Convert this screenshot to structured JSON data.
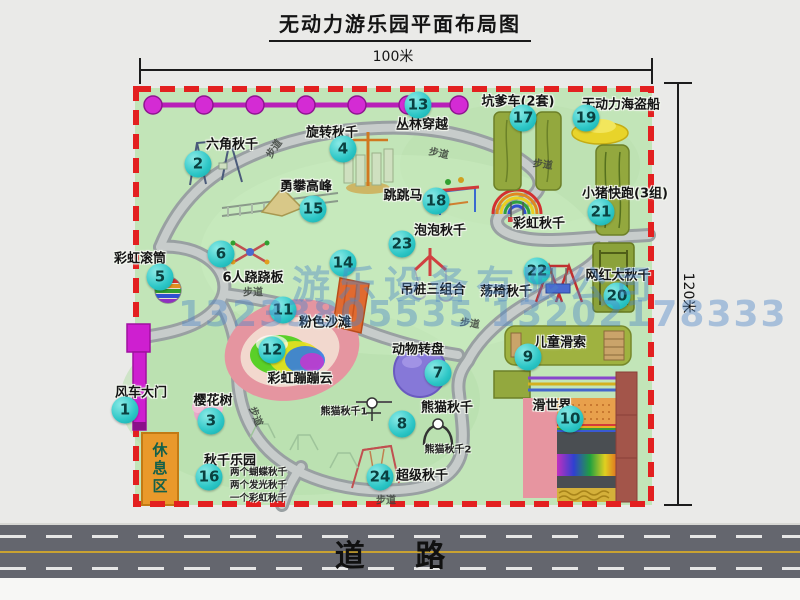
{
  "title": "无动力游乐园平面布局图",
  "dim_top": "100米",
  "dim_right": "120米",
  "road_label": "道  路",
  "rest_area": "休息区",
  "watermark": {
    "company": "游乐设备有限公司",
    "phone": "13233805535 13202178333"
  },
  "colors": {
    "park_green": "#c2e5b8",
    "border_red": "#e32020",
    "badge_cyan": "#2cc6c6",
    "gate_magenta": "#ce1fd0",
    "rest_orange": "#e9992b",
    "road_gray": "#64666e",
    "chain_pink": "#d42bd4",
    "equipment_olive": "#93a83e"
  },
  "features": [
    {
      "num": "1",
      "label": "风车大门",
      "lx": 141,
      "ly": 391,
      "bx": 125,
      "by": 410
    },
    {
      "num": "2",
      "label": "六角秋千",
      "lx": 232,
      "ly": 143,
      "bx": 198,
      "by": 164
    },
    {
      "num": "3",
      "label": "樱花树",
      "lx": 213,
      "ly": 399,
      "bx": 211,
      "by": 421
    },
    {
      "num": "4",
      "label": "旋转秋千",
      "lx": 332,
      "ly": 131,
      "bx": 343,
      "by": 149
    },
    {
      "num": "5",
      "label": "彩虹滚筒",
      "lx": 140,
      "ly": 257,
      "bx": 160,
      "by": 277
    },
    {
      "num": "6",
      "label": "6人跷跷板",
      "lx": 253,
      "ly": 276,
      "bx": 221,
      "by": 254
    },
    {
      "num": "7",
      "label": "动物转盘",
      "lx": 418,
      "ly": 348,
      "bx": 438,
      "by": 373
    },
    {
      "num": "8",
      "label": "熊猫秋千",
      "lx": 447,
      "ly": 406,
      "bx": 402,
      "by": 424
    },
    {
      "num": "9",
      "label": "儿童滑索",
      "lx": 560,
      "ly": 341,
      "bx": 528,
      "by": 357
    },
    {
      "num": "10",
      "label": "滑世界",
      "lx": 552,
      "ly": 404,
      "bx": 570,
      "by": 419
    },
    {
      "num": "11",
      "label": "粉色沙滩",
      "lx": 325,
      "ly": 321,
      "bx": 283,
      "by": 310
    },
    {
      "num": "12",
      "label": "彩虹蹦蹦云",
      "lx": 300,
      "ly": 377,
      "bx": 272,
      "by": 350
    },
    {
      "num": "13",
      "label": "丛林穿越",
      "lx": 422,
      "ly": 123,
      "bx": 418,
      "by": 105
    },
    {
      "num": "14",
      "label": "吊桩三组合",
      "lx": 433,
      "ly": 288,
      "bx": 343,
      "by": 263
    },
    {
      "num": "15",
      "label": "勇攀高峰",
      "lx": 306,
      "ly": 185,
      "bx": 313,
      "by": 209
    },
    {
      "num": "16",
      "label": "秋千乐园",
      "lx": 230,
      "ly": 459,
      "bx": 209,
      "by": 477
    },
    {
      "num": "17",
      "label": "坑爹车(2套)",
      "lx": 518,
      "ly": 100,
      "bx": 523,
      "by": 118
    },
    {
      "num": "18",
      "label": "跳跳马",
      "lx": 403,
      "ly": 194,
      "bx": 436,
      "by": 201
    },
    {
      "num": "19",
      "label": "无动力海盗船",
      "lx": 621,
      "ly": 103,
      "bx": 586,
      "by": 118
    },
    {
      "num": "20",
      "label": "网红大秋千",
      "lx": 618,
      "ly": 274,
      "bx": 617,
      "by": 296
    },
    {
      "num": "21",
      "label": "小猪快跑(3组)",
      "lx": 625,
      "ly": 192,
      "bx": 601,
      "by": 212
    },
    {
      "num": "22",
      "label": "荡椅秋千",
      "lx": 506,
      "ly": 290,
      "bx": 537,
      "by": 271
    },
    {
      "num": "23",
      "label": "泡泡秋千",
      "lx": 440,
      "ly": 229,
      "bx": 402,
      "by": 244
    },
    {
      "num": "24",
      "label": "超级秋千",
      "lx": 422,
      "ly": 474,
      "bx": 380,
      "by": 477
    },
    {
      "num": "",
      "label": "彩虹秋千",
      "lx": 539,
      "ly": 222,
      "bx": 0,
      "by": 0
    }
  ],
  "sub_labels": [
    {
      "text": "熊猫秋千1",
      "x": 344,
      "y": 410
    },
    {
      "text": "熊猫秋千2",
      "x": 448,
      "y": 448
    }
  ],
  "swing_park_items": [
    "两个蝴蝶秋千",
    "两个发光秋千",
    "一个彩虹秋千"
  ],
  "path_labels": [
    {
      "text": "步道",
      "x": 273,
      "y": 148,
      "r": -55
    },
    {
      "text": "步道",
      "x": 439,
      "y": 152,
      "r": 12
    },
    {
      "text": "步道",
      "x": 543,
      "y": 163,
      "r": 8
    },
    {
      "text": "步道",
      "x": 253,
      "y": 291,
      "r": 0
    },
    {
      "text": "步道",
      "x": 470,
      "y": 322,
      "r": 8
    },
    {
      "text": "步道",
      "x": 257,
      "y": 416,
      "r": 68
    },
    {
      "text": "步道",
      "x": 386,
      "y": 499,
      "r": 0
    }
  ]
}
